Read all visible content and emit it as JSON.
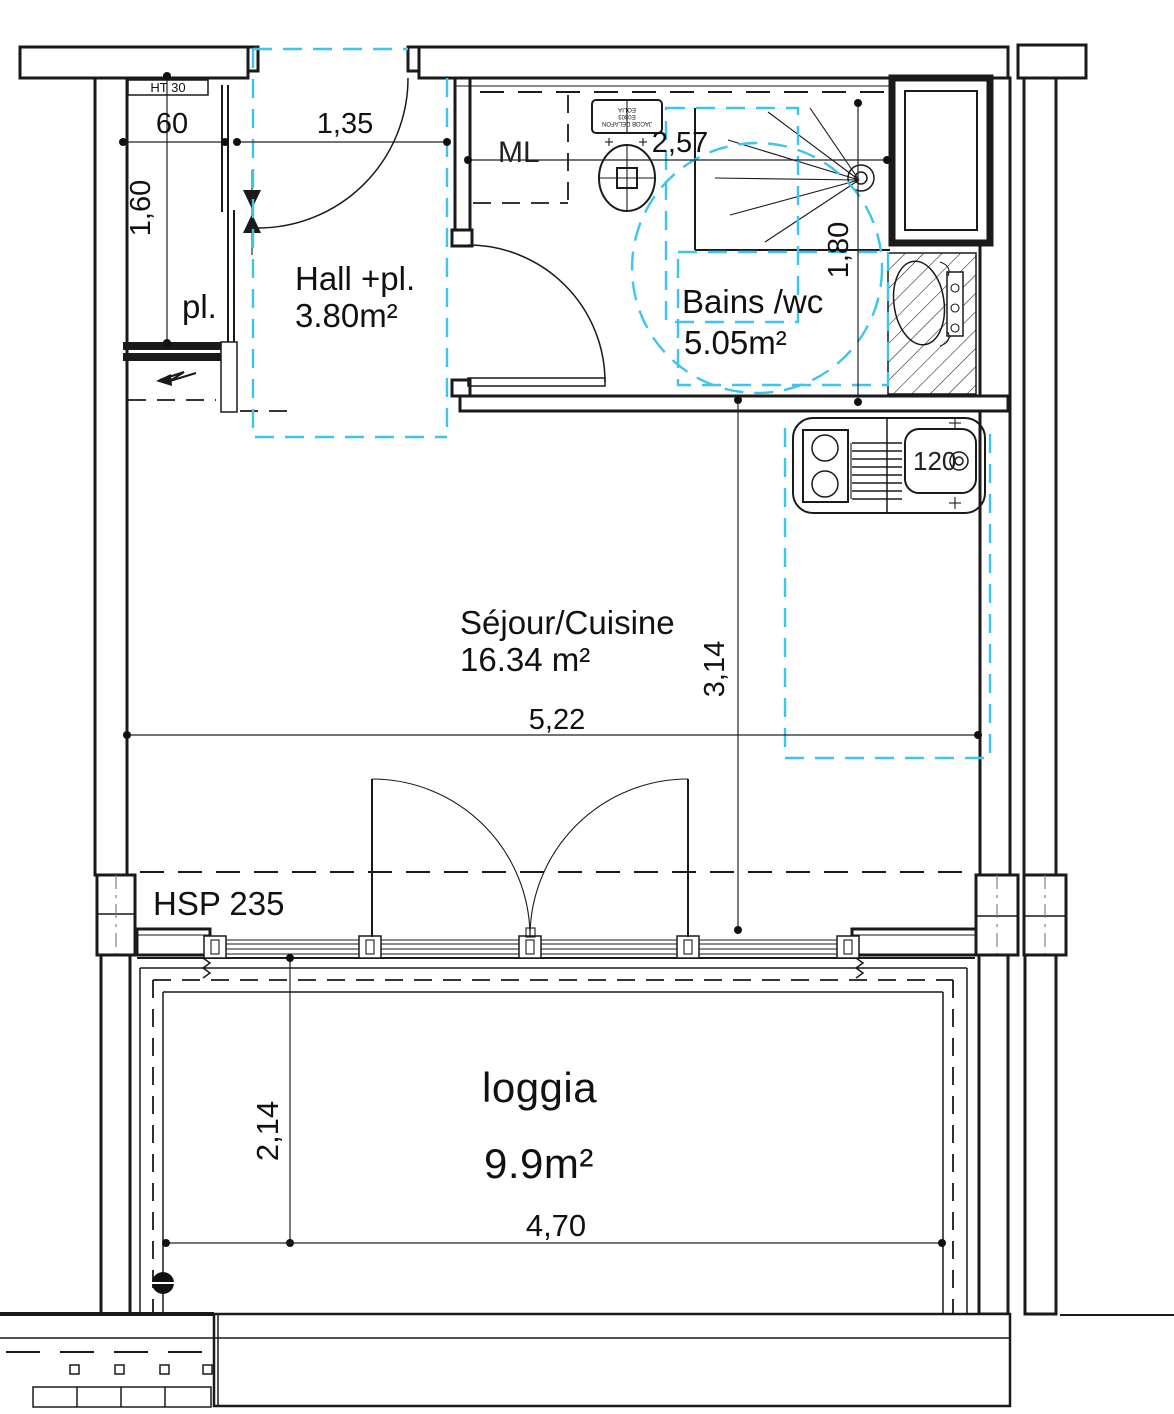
{
  "rooms": {
    "hall": {
      "name": "Hall +pl.",
      "area": "3.80m²"
    },
    "bath": {
      "name": "Bains /wc",
      "area": "5.05m²"
    },
    "living": {
      "name": "Séjour/Cuisine",
      "area": "16.34 m²"
    },
    "loggia": {
      "name": "loggia",
      "area": "9.9m²"
    },
    "closet": {
      "label": "pl."
    }
  },
  "annotations": {
    "lintel_height": "HT 30",
    "ceiling_height": "HSP 235",
    "washing_machine": "ML",
    "sink_width": "120",
    "wc_brand_line1": "JACOB DELAFON",
    "wc_brand_line2": "E0303",
    "wc_brand_line3": "EOLIA"
  },
  "dimensions": {
    "closet_depth": "60",
    "entry_width": "1,35",
    "closet_length": "1,60",
    "bath_width": "2,57",
    "bath_depth": "1,80",
    "living_depth": "3,14",
    "living_width": "5,22",
    "loggia_depth": "2,14",
    "loggia_width": "4,70"
  },
  "colors": {
    "ink": "#1a1a1a",
    "accent": "#3fc3ef"
  }
}
